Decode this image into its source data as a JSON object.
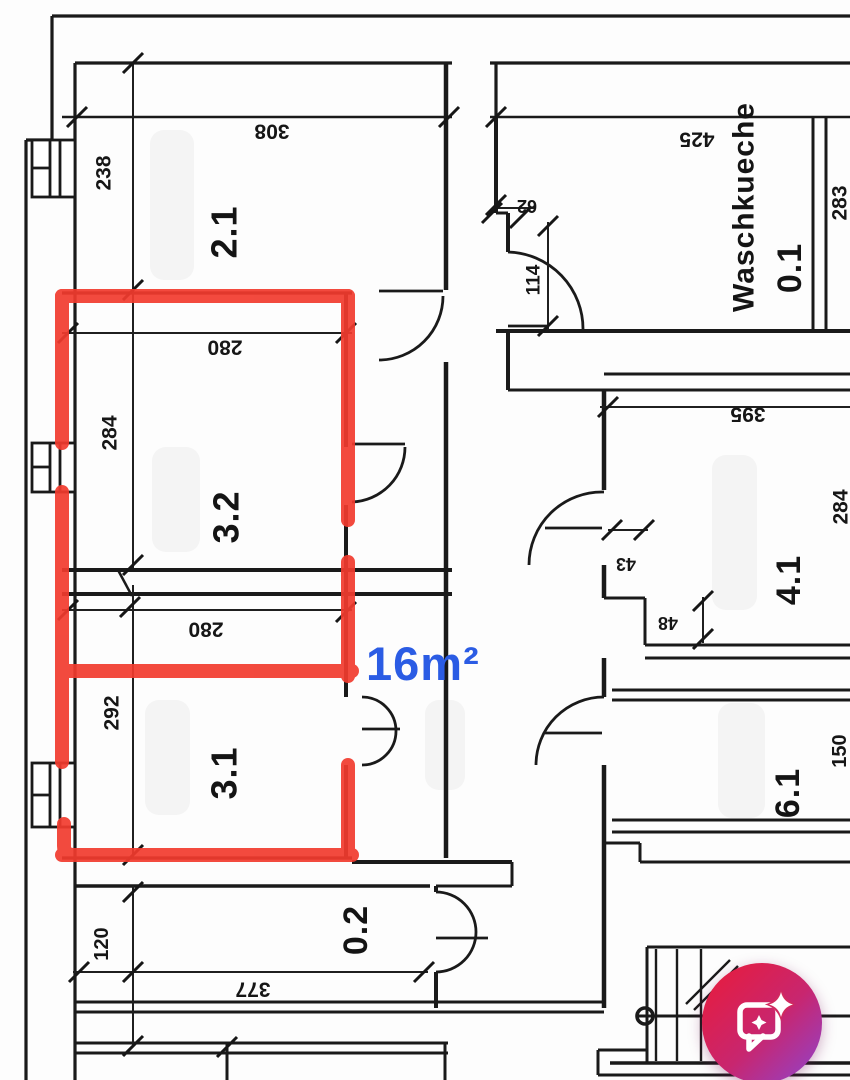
{
  "document": {
    "type": "floor-plan-scan",
    "ink_color": "#1a1a1a",
    "paper_color": "#fdfdfd"
  },
  "annotation": {
    "area_label": "16m²",
    "highlight_color": "#f23b2e",
    "label_color": "#2b5ce4"
  },
  "floor_plan": {
    "rooms": [
      {
        "label": "2.1"
      },
      {
        "label": "3.2"
      },
      {
        "label": "3.1"
      },
      {
        "label": "0.2"
      },
      {
        "label": "Waschkueche"
      },
      {
        "label": "0.1"
      },
      {
        "label": "4.1"
      },
      {
        "label": "6.1"
      }
    ],
    "dimensions": [
      {
        "value": "308"
      },
      {
        "value": "238"
      },
      {
        "value": "280"
      },
      {
        "value": "284"
      },
      {
        "value": "280"
      },
      {
        "value": "292"
      },
      {
        "value": "377"
      },
      {
        "value": "120"
      },
      {
        "value": "425"
      },
      {
        "value": "283"
      },
      {
        "value": "62"
      },
      {
        "value": "114"
      },
      {
        "value": "395"
      },
      {
        "value": "284"
      },
      {
        "value": "43"
      },
      {
        "value": "48"
      },
      {
        "value": "150"
      }
    ]
  },
  "chat_button": {
    "icon": "chat-sparkle-icon",
    "gradient_start": "#e41d42",
    "gradient_end": "#8e44cf"
  }
}
